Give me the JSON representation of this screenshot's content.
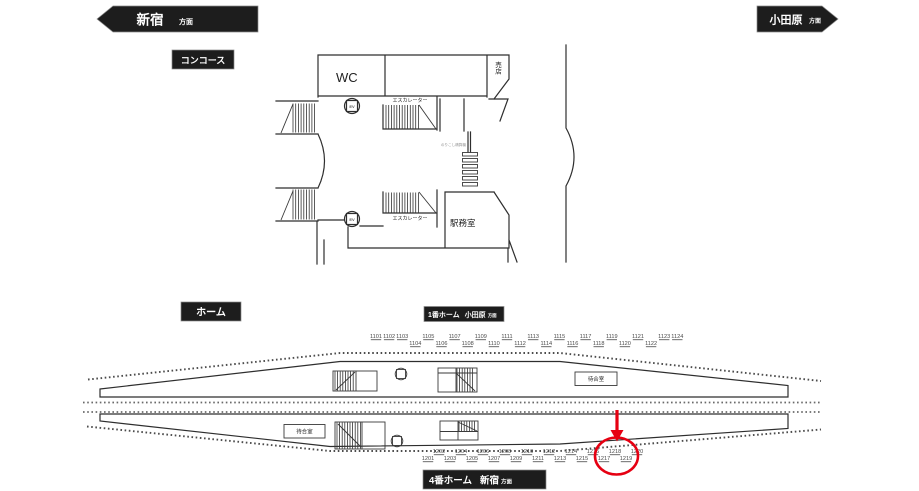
{
  "page": {
    "background": "#ffffff",
    "line_color": "#2e2e2e",
    "accent_red": "#e60012",
    "badge_bg": "#1d1d1d"
  },
  "header": {
    "left_arrow": {
      "station": "新宿",
      "suffix": "方面",
      "direction": "left"
    },
    "right_arrow": {
      "station": "小田原",
      "suffix": "方面",
      "direction": "right"
    }
  },
  "concourse": {
    "badge": "コンコース",
    "labels": {
      "wc": "WC",
      "shop": "売店",
      "escalator_top": "エスカレーター",
      "escalator_bottom": "エスカレーター",
      "station_office": "駅務室",
      "ev": "EV",
      "small_sign": "のりこし精算機"
    }
  },
  "platform": {
    "badge": "ホーム",
    "platform1_badge": {
      "name": "1番ホーム",
      "direction": "小田原",
      "suffix": "方面"
    },
    "platform4_badge": {
      "name": "4番ホーム",
      "direction": "新宿",
      "suffix": "方面"
    },
    "waiting_room_upper": "待合室",
    "waiting_room_lower": "待合室",
    "ev": "EV",
    "top_numbers": [
      "1101",
      "1102",
      "1103",
      "1104",
      "1105",
      "1106",
      "1107",
      "1108",
      "1109",
      "1110",
      "1111",
      "1112",
      "1113",
      "1114",
      "1115",
      "1116",
      "1117",
      "1118",
      "1119",
      "1120",
      "1121",
      "1122",
      "1123",
      "1124"
    ],
    "bottom_numbers": [
      "1201",
      "1202",
      "1203",
      "1204",
      "1205",
      "1206",
      "1207",
      "1208",
      "1209",
      "1210",
      "1211",
      "1212",
      "1213",
      "1214",
      "1215",
      "1216",
      "1217",
      "1218",
      "1219",
      "1220"
    ],
    "highlight": {
      "circled_numbers": [
        "1218",
        "1219"
      ],
      "arrow_target": "1218",
      "color": "#e60012"
    }
  }
}
